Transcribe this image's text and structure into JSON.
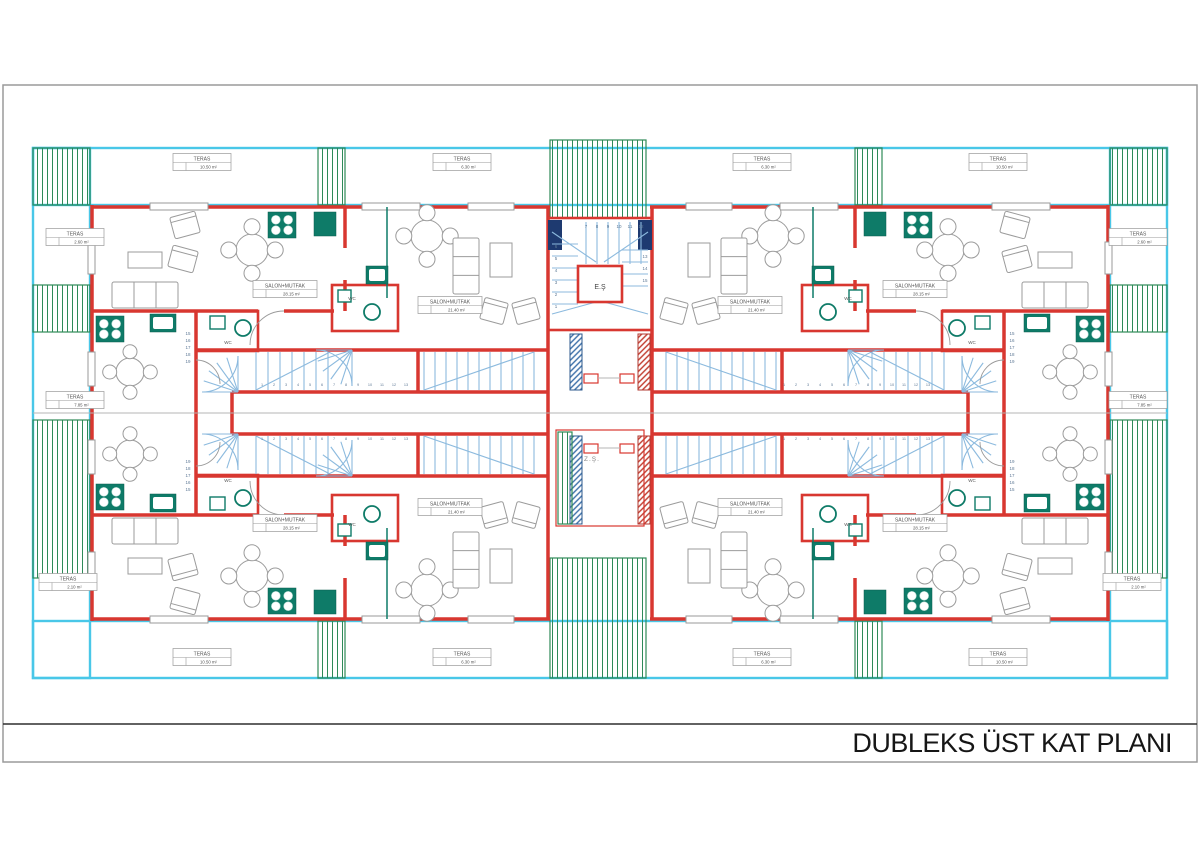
{
  "title_block": {
    "title": "DUBLEKS ÜST KAT PLANI"
  },
  "colors": {
    "wall_red": "#d83730",
    "terrace_cyan": "#49c7e8",
    "deck_green": "#2e8a58",
    "stair_blue": "#8cbade",
    "fixture_teal": "#0e7b68",
    "column_navy": "#1e3a70",
    "frame_gray": "#9a9a9a"
  },
  "mirror_center": [
    600,
    413
  ],
  "mirrors": [
    [
      1,
      1
    ],
    [
      -1,
      1
    ],
    [
      1,
      -1
    ],
    [
      -1,
      -1
    ]
  ],
  "terraces": {
    "cyan_bands": [
      [
        33,
        148,
        1134,
        57
      ],
      [
        33,
        621,
        1134,
        57
      ],
      [
        33,
        148,
        57,
        530
      ],
      [
        1110,
        148,
        57,
        530
      ]
    ],
    "hatches": [
      [
        33,
        148,
        57,
        57
      ],
      [
        33,
        285,
        57,
        47
      ],
      [
        33,
        420,
        57,
        158
      ],
      [
        1110,
        148,
        57,
        57
      ],
      [
        1110,
        285,
        57,
        47
      ],
      [
        1110,
        420,
        57,
        158
      ],
      [
        318,
        148,
        27,
        57
      ],
      [
        855,
        148,
        27,
        57
      ],
      [
        318,
        621,
        27,
        57
      ],
      [
        855,
        621,
        27,
        57
      ],
      [
        550,
        140,
        96,
        78
      ],
      [
        550,
        558,
        96,
        120
      ]
    ]
  },
  "quadrant_items": [
    {
      "t": "l",
      "c": "wall",
      "d": [
        92,
        207,
        150,
        207
      ],
      "n": "exterior-wall"
    },
    {
      "t": "l",
      "c": "wall",
      "d": [
        208,
        207,
        362,
        207
      ],
      "n": "exterior-wall"
    },
    {
      "t": "l",
      "c": "wall",
      "d": [
        420,
        207,
        468,
        207
      ],
      "n": "exterior-wall"
    },
    {
      "t": "l",
      "c": "wall",
      "d": [
        514,
        207,
        550,
        207
      ],
      "n": "exterior-wall"
    },
    {
      "t": "l",
      "c": "wall",
      "d": [
        92,
        205,
        92,
        242
      ],
      "n": "exterior-wall"
    },
    {
      "t": "l",
      "c": "wall",
      "d": [
        92,
        274,
        92,
        352
      ],
      "n": "exterior-wall"
    },
    {
      "t": "l",
      "c": "wall",
      "d": [
        92,
        386,
        92,
        414
      ],
      "n": "exterior-wall"
    },
    {
      "t": "l",
      "c": "wall",
      "d": [
        92,
        311,
        258,
        311
      ],
      "n": "interior-wall"
    },
    {
      "t": "l",
      "c": "wall",
      "d": [
        284,
        311,
        334,
        311
      ],
      "n": "interior-wall"
    },
    {
      "t": "l",
      "c": "wall",
      "d": [
        196,
        311,
        196,
        414
      ],
      "n": "interior-wall"
    },
    {
      "t": "l",
      "c": "wall",
      "d": [
        548,
        207,
        548,
        414
      ],
      "n": "core-wall"
    },
    {
      "t": "l",
      "c": "wall",
      "d": [
        196,
        350,
        548,
        350
      ],
      "n": "corridor-wall"
    },
    {
      "t": "l",
      "c": "wall",
      "d": [
        232,
        392,
        548,
        392
      ],
      "n": "corridor-wall"
    },
    {
      "t": "l",
      "c": "wall",
      "d": [
        232,
        392,
        232,
        414
      ],
      "n": "corridor-wall"
    },
    {
      "t": "l",
      "c": "wall",
      "d": [
        345,
        207,
        345,
        248
      ],
      "n": "interior-wall"
    },
    {
      "t": "l",
      "c": "wall",
      "d": [
        345,
        280,
        345,
        311
      ],
      "n": "interior-wall"
    },
    {
      "t": "l",
      "c": "wall",
      "d": [
        418,
        350,
        418,
        392
      ],
      "n": "interior-wall"
    },
    {
      "t": "r",
      "c": "wallr",
      "d": [
        332,
        285,
        66,
        46
      ],
      "n": "wc-room"
    },
    {
      "t": "r",
      "c": "wallr",
      "d": [
        196,
        311,
        62,
        40
      ],
      "n": "wc-room"
    },
    {
      "t": "r",
      "c": "win",
      "d": [
        150,
        203,
        58,
        7
      ],
      "n": "window"
    },
    {
      "t": "r",
      "c": "win",
      "d": [
        362,
        203,
        58,
        7
      ],
      "n": "window"
    },
    {
      "t": "r",
      "c": "win",
      "d": [
        468,
        203,
        46,
        7
      ],
      "n": "window"
    },
    {
      "t": "r",
      "c": "win",
      "d": [
        88,
        242,
        7,
        32
      ],
      "n": "window"
    },
    {
      "t": "r",
      "c": "win",
      "d": [
        88,
        352,
        7,
        34
      ],
      "n": "window"
    },
    {
      "t": "stove",
      "d": [
        96,
        316,
        28,
        26
      ]
    },
    {
      "t": "sink",
      "d": [
        150,
        314,
        26,
        18
      ]
    },
    {
      "t": "stove",
      "d": [
        268,
        212,
        28,
        26
      ]
    },
    {
      "t": "r",
      "c": "tealf",
      "d": [
        314,
        212,
        22,
        24
      ],
      "n": "kitchen-appliance"
    },
    {
      "t": "l",
      "c": "tealline",
      "d": [
        387,
        207,
        387,
        298
      ],
      "n": "kitchen-counter"
    },
    {
      "t": "sink",
      "d": [
        366,
        266,
        22,
        18
      ]
    },
    {
      "t": "r",
      "c": "basinbox",
      "d": [
        338,
        290,
        13,
        12
      ],
      "n": "wc-cistern"
    },
    {
      "t": "basin",
      "d": [
        372,
        312,
        8
      ]
    },
    {
      "t": "r",
      "c": "basinbox",
      "d": [
        210,
        316,
        15,
        13
      ],
      "n": "wc-cistern"
    },
    {
      "t": "basin",
      "d": [
        243,
        328,
        8
      ]
    },
    {
      "t": "treadsv",
      "d": [
        256,
        12,
        7,
        352,
        390
      ]
    },
    {
      "t": "treadsv",
      "d": [
        424,
        11,
        11,
        352,
        390
      ]
    },
    {
      "t": "l",
      "c": "stair",
      "d": [
        256,
        390,
        330,
        352
      ],
      "n": "stair-flight-line"
    },
    {
      "t": "l",
      "c": "stair",
      "d": [
        424,
        390,
        534,
        352
      ],
      "n": "stair-flight-line"
    },
    {
      "t": "fan",
      "d": [
        238,
        392,
        36,
        180,
        270,
        5
      ]
    },
    {
      "t": "fan",
      "d": [
        352,
        350,
        36,
        90,
        180,
        5
      ]
    },
    {
      "t": "arc",
      "d": [
        284,
        311,
        250,
        345,
        34,
        0
      ]
    },
    {
      "t": "arc",
      "d": [
        196,
        360,
        220,
        384,
        24,
        1
      ]
    },
    {
      "t": "sofa",
      "d": [
        112,
        282,
        66,
        26,
        0
      ]
    },
    {
      "t": "r",
      "c": "furn",
      "d": [
        128,
        252,
        34,
        16
      ],
      "n": "coffee-table"
    },
    {
      "t": "chairr",
      "d": [
        185,
        225,
        26,
        22,
        -15
      ]
    },
    {
      "t": "chairr",
      "d": [
        183,
        259,
        26,
        22,
        15
      ]
    },
    {
      "t": "rtable",
      "d": [
        252,
        250,
        16
      ]
    },
    {
      "t": "rtable",
      "d": [
        130,
        372,
        14
      ]
    },
    {
      "t": "rtable",
      "d": [
        427,
        236,
        16
      ]
    },
    {
      "t": "sofa",
      "d": [
        453,
        238,
        26,
        56,
        1
      ]
    },
    {
      "t": "r",
      "c": "furn",
      "d": [
        490,
        243,
        22,
        34
      ],
      "n": "side-table"
    },
    {
      "t": "chairr",
      "d": [
        494,
        311,
        24,
        22,
        15
      ]
    },
    {
      "t": "chairr",
      "d": [
        526,
        311,
        24,
        22,
        -15
      ]
    }
  ],
  "global_items": [
    {
      "t": "l",
      "c": "gray",
      "d": [
        33,
        413,
        1167,
        413
      ],
      "n": "center-section-line"
    },
    {
      "t": "r",
      "c": "wallr",
      "d": [
        548,
        218,
        104,
        112
      ],
      "n": "stair-core"
    },
    {
      "t": "r",
      "c": "navy",
      "d": [
        548,
        220,
        14,
        30
      ],
      "n": "structural-column"
    },
    {
      "t": "r",
      "c": "navy",
      "d": [
        638,
        220,
        14,
        30
      ],
      "n": "structural-column"
    },
    {
      "t": "treadsh",
      "d": [
        244,
        12,
        6,
        552,
        578
      ]
    },
    {
      "t": "treadsh",
      "d": [
        250,
        12,
        4,
        622,
        648
      ]
    },
    {
      "t": "treadsv",
      "d": [
        586,
        11,
        6,
        222,
        264
      ]
    },
    {
      "t": "l",
      "c": "stair",
      "d": [
        552,
        232,
        596,
        262
      ],
      "n": "stair-flight-line"
    },
    {
      "t": "l",
      "c": "stair",
      "d": [
        648,
        232,
        604,
        262
      ],
      "n": "stair-flight-line"
    },
    {
      "t": "l",
      "c": "stair",
      "d": [
        552,
        314,
        596,
        302
      ],
      "n": "stair-flight-line"
    },
    {
      "t": "l",
      "c": "stair",
      "d": [
        648,
        314,
        604,
        302
      ],
      "n": "stair-flight-line"
    },
    {
      "t": "r",
      "c": "wallr",
      "d": [
        578,
        266,
        44,
        36
      ],
      "n": "elevator-shaft"
    },
    {
      "t": "r",
      "c": "colblue",
      "d": [
        570,
        334,
        12,
        56
      ],
      "n": "shaft-column"
    },
    {
      "t": "r",
      "c": "colred",
      "d": [
        638,
        334,
        12,
        56
      ],
      "n": "shaft-column"
    },
    {
      "t": "r",
      "c": "colblue",
      "d": [
        570,
        436,
        12,
        88
      ],
      "n": "shaft-column"
    },
    {
      "t": "r",
      "c": "colred",
      "d": [
        638,
        436,
        12,
        88
      ],
      "n": "shaft-column"
    },
    {
      "t": "r",
      "c": "wallthin",
      "d": [
        584,
        374,
        14,
        9
      ],
      "n": "tie-beam"
    },
    {
      "t": "r",
      "c": "wallthin",
      "d": [
        620,
        374,
        14,
        9
      ],
      "n": "tie-beam"
    },
    {
      "t": "l",
      "c": "gray",
      "d": [
        598,
        378,
        620,
        378
      ],
      "n": "tie-line"
    },
    {
      "t": "r",
      "c": "wallthin",
      "d": [
        584,
        444,
        14,
        9
      ],
      "n": "tie-beam"
    },
    {
      "t": "r",
      "c": "wallthin",
      "d": [
        620,
        444,
        14,
        9
      ],
      "n": "tie-beam"
    },
    {
      "t": "l",
      "c": "gray",
      "d": [
        598,
        448,
        620,
        448
      ],
      "n": "tie-line"
    },
    {
      "t": "r",
      "c": "wallthin",
      "d": [
        556,
        430,
        88,
        96
      ],
      "n": "light-well"
    },
    {
      "t": "r",
      "c": "ghatch",
      "d": [
        558,
        432,
        14,
        92
      ],
      "n": "light-well-deck"
    }
  ],
  "teras_labels": [
    [
      202,
      162,
      "TERAS",
      "10.50 m²"
    ],
    [
      462,
      162,
      "TERAS",
      "6.30 m²"
    ],
    [
      762,
      162,
      "TERAS",
      "6.30 m²"
    ],
    [
      998,
      162,
      "TERAS",
      "10.50 m²"
    ],
    [
      75,
      237,
      "TERAS",
      "2.60 m²"
    ],
    [
      1138,
      237,
      "TERAS",
      "2.60 m²"
    ],
    [
      75,
      400,
      "TERAS",
      "7.85 m²"
    ],
    [
      1138,
      400,
      "TERAS",
      "7.85 m²"
    ],
    [
      68,
      582,
      "TERAS",
      "2.10 m²"
    ],
    [
      1132,
      582,
      "TERAS",
      "2.10 m²"
    ],
    [
      202,
      657,
      "TERAS",
      "10.50 m²"
    ],
    [
      462,
      657,
      "TERAS",
      "6.30 m²"
    ],
    [
      762,
      657,
      "TERAS",
      "6.30 m²"
    ],
    [
      998,
      657,
      "TERAS",
      "10.50 m²"
    ]
  ],
  "salon_labels": [
    [
      285,
      289,
      "SALON+MUTFAK",
      "28.15 m²"
    ],
    [
      915,
      289,
      "SALON+MUTFAK",
      "28.15 m²"
    ],
    [
      450,
      305,
      "SALON+MUTFAK",
      "21.40 m²"
    ],
    [
      750,
      305,
      "SALON+MUTFAK",
      "21.40 m²"
    ],
    [
      285,
      523,
      "SALON+MUTFAK",
      "28.15 m²"
    ],
    [
      915,
      523,
      "SALON+MUTFAK",
      "28.15 m²"
    ],
    [
      450,
      507,
      "SALON+MUTFAK",
      "21.40 m²"
    ],
    [
      750,
      507,
      "SALON+MUTFAK",
      "21.40 m²"
    ]
  ],
  "wc_labels": [
    [
      352,
      300
    ],
    [
      848,
      300
    ],
    [
      228,
      344
    ],
    [
      972,
      344
    ],
    [
      352,
      526
    ],
    [
      848,
      526
    ],
    [
      228,
      482
    ],
    [
      972,
      482
    ]
  ],
  "wc_text": "WC",
  "special_texts": [
    {
      "x": 600,
      "y": 289,
      "s": "E.Ş",
      "fs": 7,
      "c": "dark",
      "n": "elevator-shaft-label"
    },
    {
      "x": 592,
      "y": 461,
      "s": "Z.Ş.",
      "fs": 6.5,
      "c": "mid",
      "n": "shaft-label"
    }
  ],
  "core_numbers": {
    "left": {
      "x": 556,
      "y0": 308,
      "step": -12,
      "nums": [
        1,
        2,
        3,
        4,
        5,
        6
      ]
    },
    "top": {
      "x0": 586,
      "step": 11,
      "y": 228,
      "nums": [
        7,
        8,
        9,
        10,
        11,
        12
      ]
    },
    "right": {
      "x": 645,
      "y0": 258,
      "step": 12,
      "nums": [
        13,
        14,
        15
      ]
    }
  },
  "number_runs": [
    {
      "x0": 262,
      "y": 386,
      "step": 12,
      "count": 13,
      "start": 1
    },
    {
      "x0": 784,
      "y": 386,
      "step": 12,
      "count": 13,
      "start": 1
    },
    {
      "x0": 262,
      "y": 440,
      "step": 12,
      "count": 13,
      "start": 1
    },
    {
      "x0": 784,
      "y": 440,
      "step": 12,
      "count": 13,
      "start": 1
    }
  ],
  "number_cols": [
    {
      "x": 188,
      "y0": 363,
      "step": -7,
      "nums": [
        19,
        18,
        17,
        16,
        15
      ]
    },
    {
      "x": 1012,
      "y0": 363,
      "step": -7,
      "nums": [
        19,
        18,
        17,
        16,
        15
      ]
    },
    {
      "x": 188,
      "y0": 463,
      "step": 7,
      "nums": [
        19,
        18,
        17,
        16,
        15
      ]
    },
    {
      "x": 1012,
      "y0": 463,
      "step": 7,
      "nums": [
        19,
        18,
        17,
        16,
        15
      ]
    }
  ]
}
